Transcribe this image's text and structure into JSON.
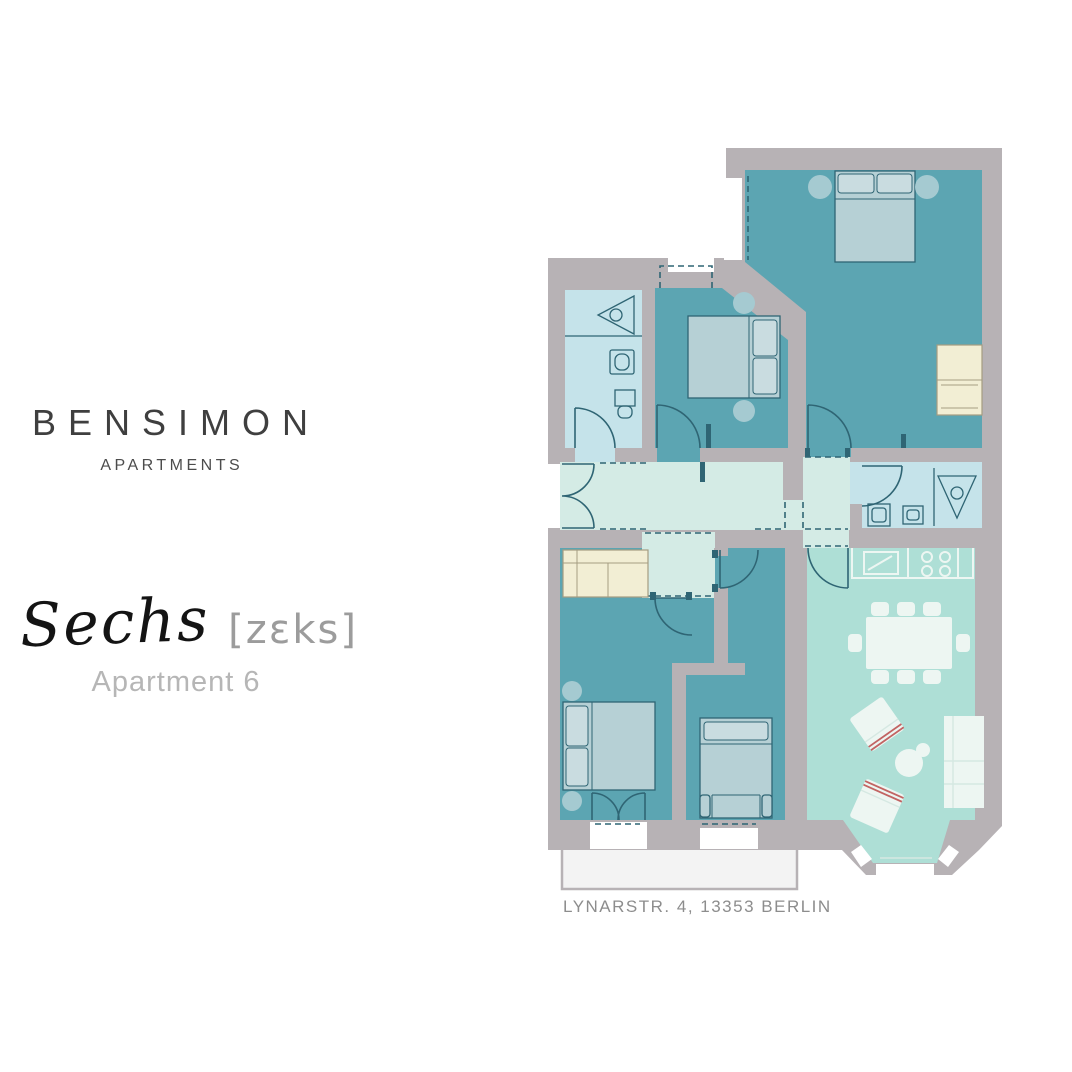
{
  "brand": {
    "name": "BENSIMON",
    "subtitle": "APARTMENTS"
  },
  "apartment": {
    "script_name": "Sechs",
    "pronunciation": "[zɛks]",
    "label": "Apartment 6"
  },
  "address": "LYNARSTR. 4, 13353 BERLIN",
  "colors": {
    "background": "#ffffff",
    "brand_text": "#3f3f3f",
    "subtitle_text": "#4c4c4c",
    "script_text": "#141414",
    "pronunciation_text": "#9c9c9c",
    "label_text": "#b6b6b6",
    "address_text": "#8d8d8d"
  },
  "floorplan": {
    "rooms": [
      "bedroom-1",
      "bedroom-2",
      "bathroom-1",
      "hallway",
      "bathroom-2",
      "bedroom-3",
      "bedroom-4",
      "kitchen-living-dining",
      "balcony",
      "bay-window"
    ],
    "colors": {
      "wall": "#b7b2b5",
      "room_teal": "#5ca5b2",
      "bathroom_blue": "#c5e3ea",
      "hallway_mint": "#d4ebe5",
      "living_mint": "#aedfd6",
      "furniture_cream": "#f2eed4",
      "cream_stroke": "#a59d82",
      "furniture_light": "#b6d0d5",
      "furniture_white": "#edf6f2",
      "outline_dark": "#2f6574",
      "balcony_fill": "#f3f3f3",
      "accent_red": "#c26463",
      "window_white": "#ffffff"
    }
  }
}
